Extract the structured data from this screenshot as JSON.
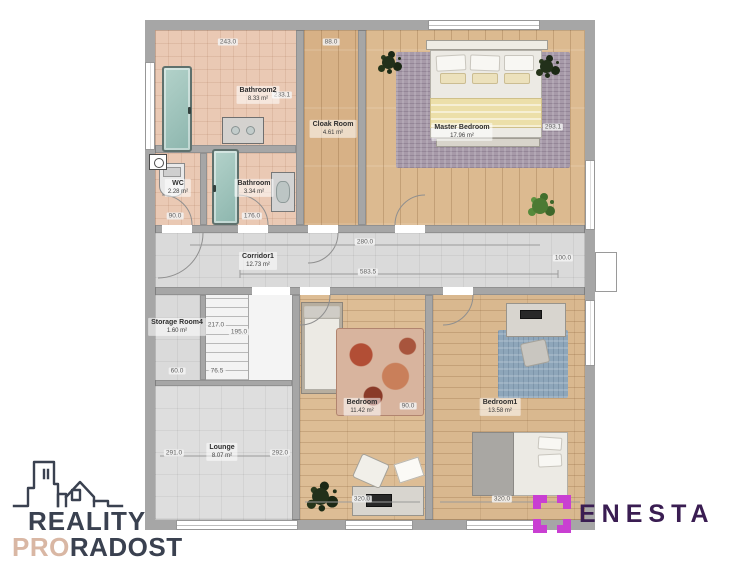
{
  "plan": {
    "rooms": [
      {
        "name": "Bathroom2",
        "area": "8.33 m²"
      },
      {
        "name": "WC",
        "area": "2.28 m²"
      },
      {
        "name": "Bathroom",
        "area": "3.34 m²"
      },
      {
        "name": "Cloak Room",
        "area": "4.61 m²"
      },
      {
        "name": "Master Bedroom",
        "area": "17.96 m²"
      },
      {
        "name": "Corridor1",
        "area": "12.73 m²"
      },
      {
        "name": "Storage Room4",
        "area": "1.60 m²"
      },
      {
        "name": "Lounge",
        "area": "8.07 m²"
      },
      {
        "name": "Bedroom",
        "area": "11.42 m²"
      },
      {
        "name": "Bedroom1",
        "area": "13.58 m²"
      }
    ],
    "dimensions": [
      "243.0",
      "88.0",
      "233.1",
      "90.0",
      "176.0",
      "280.0",
      "583.5",
      "100.0",
      "217.0",
      "195.0",
      "76.5",
      "60.0",
      "291.0",
      "292.0",
      "320.0",
      "320.0",
      "90.0",
      "293.1"
    ],
    "colors": {
      "wall": "#a6a6a6",
      "tile_floor": "#eac9b4",
      "wood_floor": "#d7b186",
      "corridor_floor": "#dadada",
      "shower_glass": "#9cc0b8",
      "master_rug": "#a79aa9",
      "blue_rug": "#8ea6ba",
      "floral_rug": "#c9826a"
    }
  },
  "branding": {
    "reality": {
      "line1": "REALITY",
      "line2_accent": "PRO",
      "line2_rest": "RADOST",
      "accent_color": "#d9b7a4",
      "text_color": "#3a4150"
    },
    "enesta": {
      "name": "ENESTA",
      "icon_color": "#c93fd2",
      "text_color": "#3a1d52"
    }
  }
}
